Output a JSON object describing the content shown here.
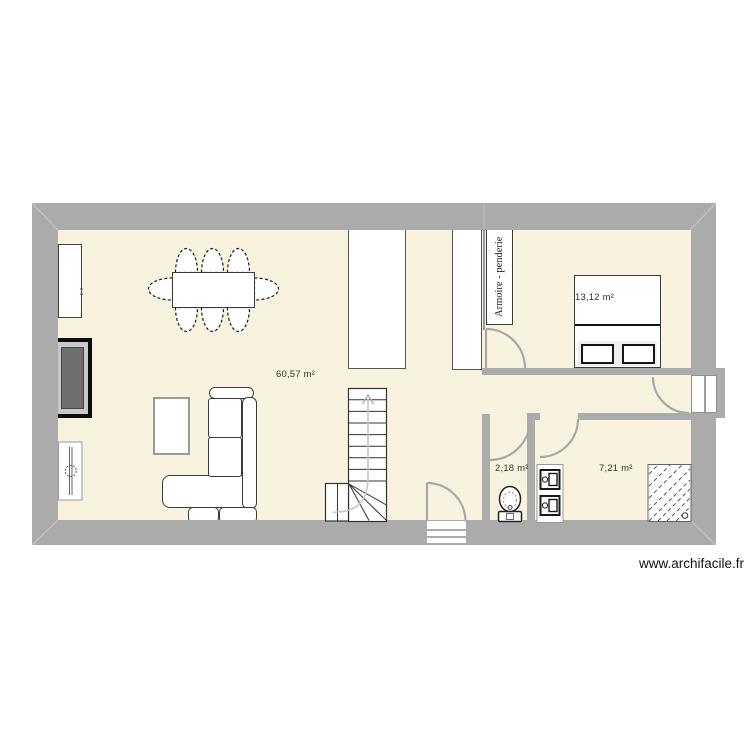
{
  "colors": {
    "wall": "#ababab",
    "floor": "#f8f3de",
    "outline": "#333333",
    "door_arc": "#a8a8a8",
    "watermark_text": "#111111"
  },
  "rooms": {
    "living": {
      "label": "60,57 m²"
    },
    "bedroom": {
      "label": "13,12 m²"
    },
    "wc": {
      "label": "2,18 m²"
    },
    "utility": {
      "label": "7,21 m²"
    }
  },
  "closet": {
    "label": "Armoire - penderie"
  },
  "footer": {
    "watermark": "www.archifacile.fr"
  },
  "objects": [
    "dining-table",
    "dining-chairs",
    "sideboard",
    "fireplace",
    "radiator",
    "coffee-table",
    "corner-sofa",
    "staircase",
    "wardrobe",
    "closet",
    "double-bed",
    "toilet",
    "washer-dryer-column",
    "shower-hatch",
    "entry-door",
    "interior-doors",
    "double-window"
  ]
}
